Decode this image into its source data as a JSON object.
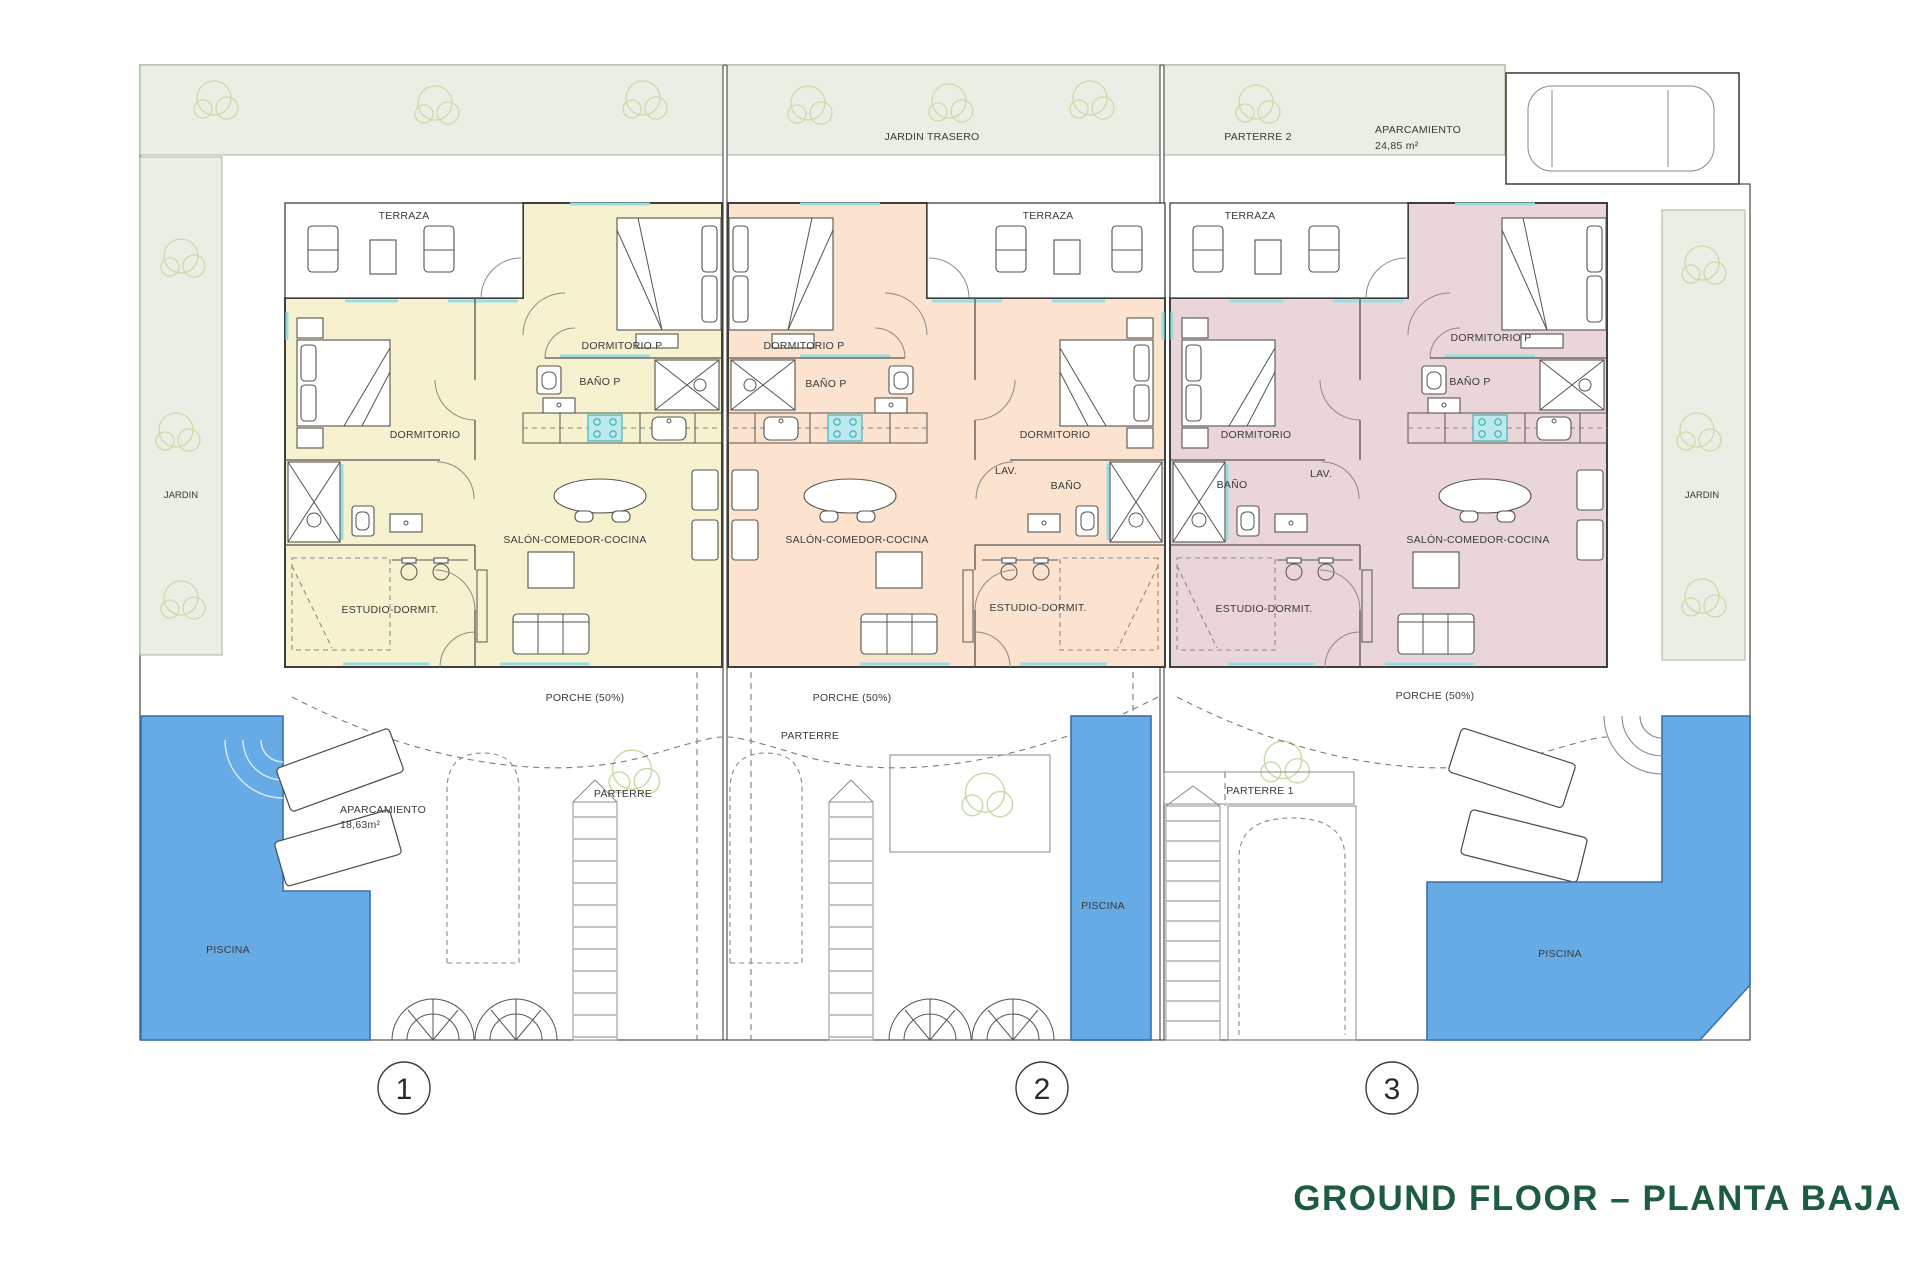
{
  "title": "GROUND FLOOR – PLANTA BAJA",
  "colors": {
    "pool": "#66abe6",
    "pool_edge": "#3a6fae",
    "unit1": "#f6f2cf",
    "unit2": "#fbe3d0",
    "unit3": "#ead6d9",
    "garden": "#e9efe4",
    "garden_edge": "#a3b79a",
    "tree": "#c9dca6",
    "wall": "#3e3e3c",
    "cyan": "#9adde0",
    "title": "#1d5c40"
  },
  "site": {
    "jardin_trasero": "JARDIN TRASERO",
    "parterre_2": "PARTERRE 2",
    "aparcamiento_label": "APARCAMIENTO",
    "aparcamiento_area": "24,85 m²",
    "jardin_left": "JARDIN",
    "jardin_right": "JARDIN"
  },
  "units": [
    {
      "number": "1",
      "terraza": "TERRAZA",
      "dormitorio_p": "DORMITORIO P",
      "bano_p": "BAÑO P",
      "dormitorio": "DORMITORIO",
      "estudio": "ESTUDIO-DORMIT.",
      "salon": "SALÓN-COMEDOR-COCINA",
      "porche": "PORCHE (50%)",
      "parterre": "PARTERRE",
      "aparcamiento_label": "APARCAMIENTO",
      "aparcamiento_area": "18,63m²",
      "piscina": "PISCINA"
    },
    {
      "number": "2",
      "terraza": "TERRAZA",
      "dormitorio_p": "DORMITORIO P",
      "bano_p": "BAÑO P",
      "dormitorio": "DORMITORIO",
      "lav": "LAV.",
      "bano": "BAÑO",
      "estudio": "ESTUDIO-DORMIT.",
      "salon": "SALÓN-COMEDOR-COCINA",
      "porche": "PORCHE (50%)",
      "parterre": "PARTERRE",
      "piscina": "PISCINA"
    },
    {
      "number": "3",
      "terraza": "TERRAZA",
      "dormitorio_p": "DORMITORIO P",
      "bano_p": "BAÑO P",
      "dormitorio": "DORMITORIO",
      "lav": "LAV.",
      "bano": "BAÑO",
      "estudio": "ESTUDIO-DORMIT.",
      "salon": "SALÓN-COMEDOR-COCINA",
      "porche": "PORCHE (50%)",
      "parterre_1": "PARTERRE 1",
      "piscina": "PISCINA"
    }
  ]
}
